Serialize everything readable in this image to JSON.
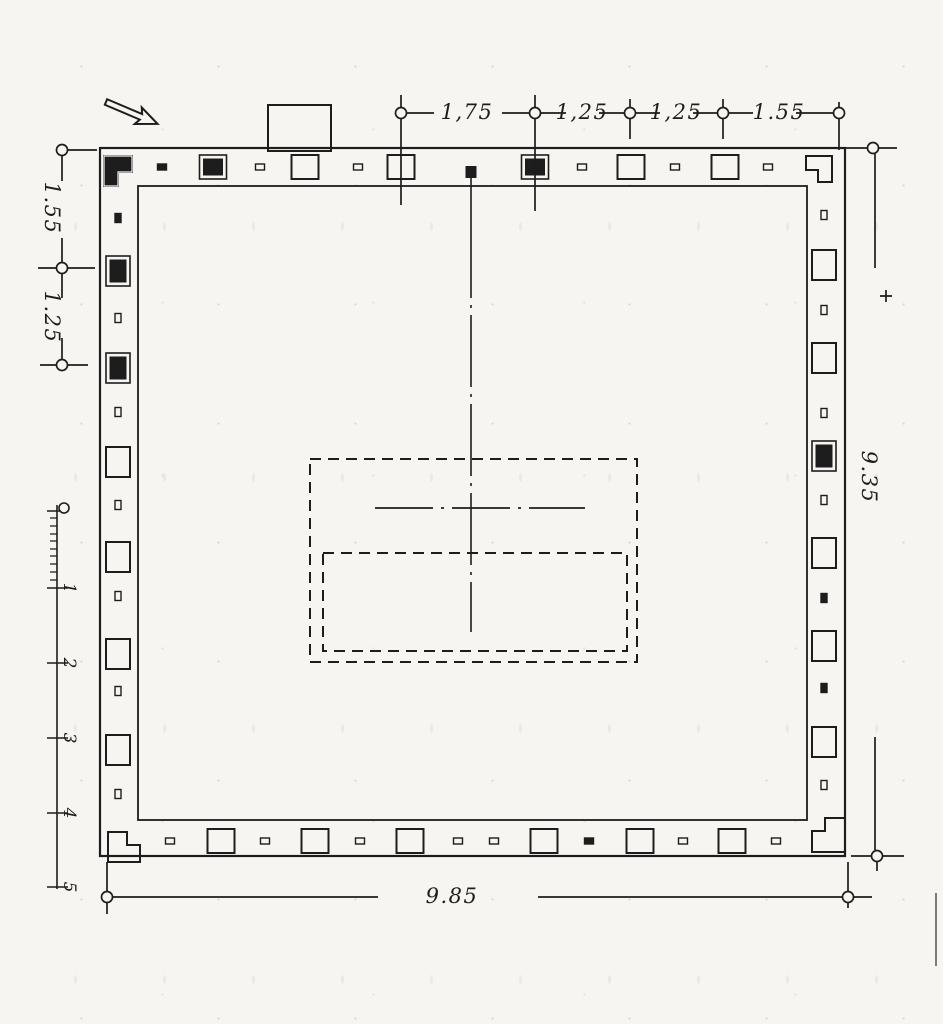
{
  "drawing": {
    "kind": "scanned plan drawing",
    "ink_color": "#1d1d1d",
    "paper_color": "#f6f5f1"
  },
  "dimensions": {
    "top": {
      "labels": [
        "1,75",
        "1,25",
        "1,25",
        "1.55"
      ]
    },
    "left": {
      "labels": [
        "1.55",
        "1.25"
      ]
    },
    "right": {
      "label": "9.35"
    },
    "bottom": {
      "label": "9.85"
    }
  },
  "scale_bar": {
    "labels": [
      "1",
      "2",
      "3",
      "4",
      "5"
    ]
  },
  "icons": {
    "north_arrow": "open-outline-arrow-pointing-lower-right"
  },
  "plan": {
    "outer_wall": [
      100,
      148,
      845,
      856
    ],
    "inner_wall": [
      138,
      186,
      807,
      820
    ],
    "gate_square": [
      471,
      172
    ],
    "cella_outer": [
      310,
      459,
      637,
      662
    ],
    "cella_inner": [
      323,
      553,
      627,
      651
    ],
    "corners": {
      "tl": "filled",
      "tr": "open",
      "bl": "open",
      "br": "open"
    },
    "walls": {
      "top": {
        "axis": "x",
        "center": 167,
        "pillars": [
          [
            213,
            "filled"
          ],
          [
            305,
            "open"
          ],
          [
            401,
            "open"
          ],
          [
            535,
            "filled"
          ],
          [
            631,
            "open"
          ],
          [
            725,
            "open"
          ]
        ],
        "ticks": [
          [
            162,
            "filled"
          ],
          [
            260,
            "open"
          ],
          [
            358,
            "open"
          ],
          [
            582,
            "open"
          ],
          [
            675,
            "open"
          ],
          [
            768,
            "open"
          ]
        ]
      },
      "bottom": {
        "axis": "x",
        "center": 841,
        "pillars": [
          [
            221,
            "open"
          ],
          [
            315,
            "open"
          ],
          [
            410,
            "open"
          ],
          [
            544,
            "open"
          ],
          [
            640,
            "open"
          ],
          [
            732,
            "open"
          ]
        ],
        "ticks": [
          [
            170,
            "open"
          ],
          [
            265,
            "open"
          ],
          [
            360,
            "open"
          ],
          [
            458,
            "open"
          ],
          [
            494,
            "open"
          ],
          [
            589,
            "filled"
          ],
          [
            683,
            "open"
          ],
          [
            776,
            "open"
          ]
        ]
      },
      "left": {
        "axis": "y",
        "center": 118,
        "pillars": [
          [
            271,
            "filled"
          ],
          [
            368,
            "filled"
          ],
          [
            462,
            "open"
          ],
          [
            557,
            "open"
          ],
          [
            654,
            "open"
          ],
          [
            750,
            "open"
          ]
        ],
        "ticks": [
          [
            218,
            "filled"
          ],
          [
            318,
            "open"
          ],
          [
            412,
            "open"
          ],
          [
            505,
            "open"
          ],
          [
            596,
            "open"
          ],
          [
            691,
            "open"
          ],
          [
            794,
            "open"
          ]
        ]
      },
      "right": {
        "axis": "y",
        "center": 824,
        "pillars": [
          [
            265,
            "open"
          ],
          [
            358,
            "open"
          ],
          [
            456,
            "filled"
          ],
          [
            553,
            "open"
          ],
          [
            646,
            "open"
          ],
          [
            742,
            "open"
          ]
        ],
        "ticks": [
          [
            215,
            "open"
          ],
          [
            310,
            "open"
          ],
          [
            413,
            "open"
          ],
          [
            500,
            "open"
          ],
          [
            598,
            "filled"
          ],
          [
            688,
            "filled"
          ],
          [
            785,
            "open"
          ]
        ]
      }
    }
  }
}
